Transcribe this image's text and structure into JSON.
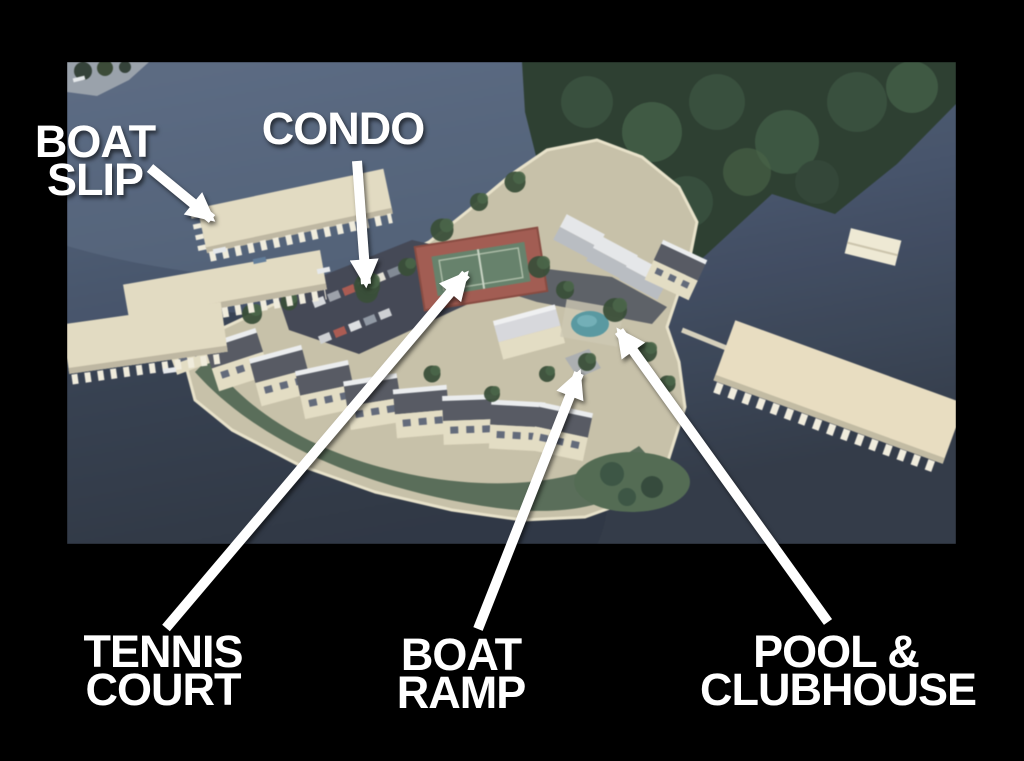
{
  "annotations": {
    "boat_slip": {
      "line1": "BOAT",
      "line2": "SLIP"
    },
    "condo": {
      "line1": "CONDO"
    },
    "tennis_court": {
      "line1": "TENNIS",
      "line2": "COURT"
    },
    "boat_ramp": {
      "line1": "BOAT",
      "line2": "RAMP"
    },
    "pool_clubhouse": {
      "line1": "POOL &",
      "line2": "CLUBHOUSE"
    }
  },
  "arrows": {
    "boat-slip": {
      "x1": 150,
      "y1": 168,
      "x2": 212,
      "y2": 219
    },
    "condo": {
      "x1": 357,
      "y1": 161,
      "x2": 366,
      "y2": 284
    },
    "tennis-court": {
      "x1": 166,
      "y1": 628,
      "x2": 466,
      "y2": 274
    },
    "boat-ramp": {
      "x1": 478,
      "y1": 629,
      "x2": 579,
      "y2": 373
    },
    "pool-clubhouse": {
      "x1": 828,
      "y1": 622,
      "x2": 619,
      "y2": 331
    }
  },
  "colors": {
    "background": "#000000",
    "label_text": "#ffffff",
    "arrow": "#ffffff",
    "water_top": "#53647f",
    "water_bottom": "#2b3444",
    "dock": "#e6ddc0",
    "dock_slips": "#f4efdd",
    "land": "#c9c2a6",
    "vegetation": "#46604a",
    "tree_canopy": "#243829",
    "building_roof": "#51555f",
    "building_face": "#e7dfc3",
    "tennis_border": "#a6564a",
    "tennis_surface": "#617f66",
    "pool": "#4f98a2",
    "pavement": "#3d4251"
  }
}
